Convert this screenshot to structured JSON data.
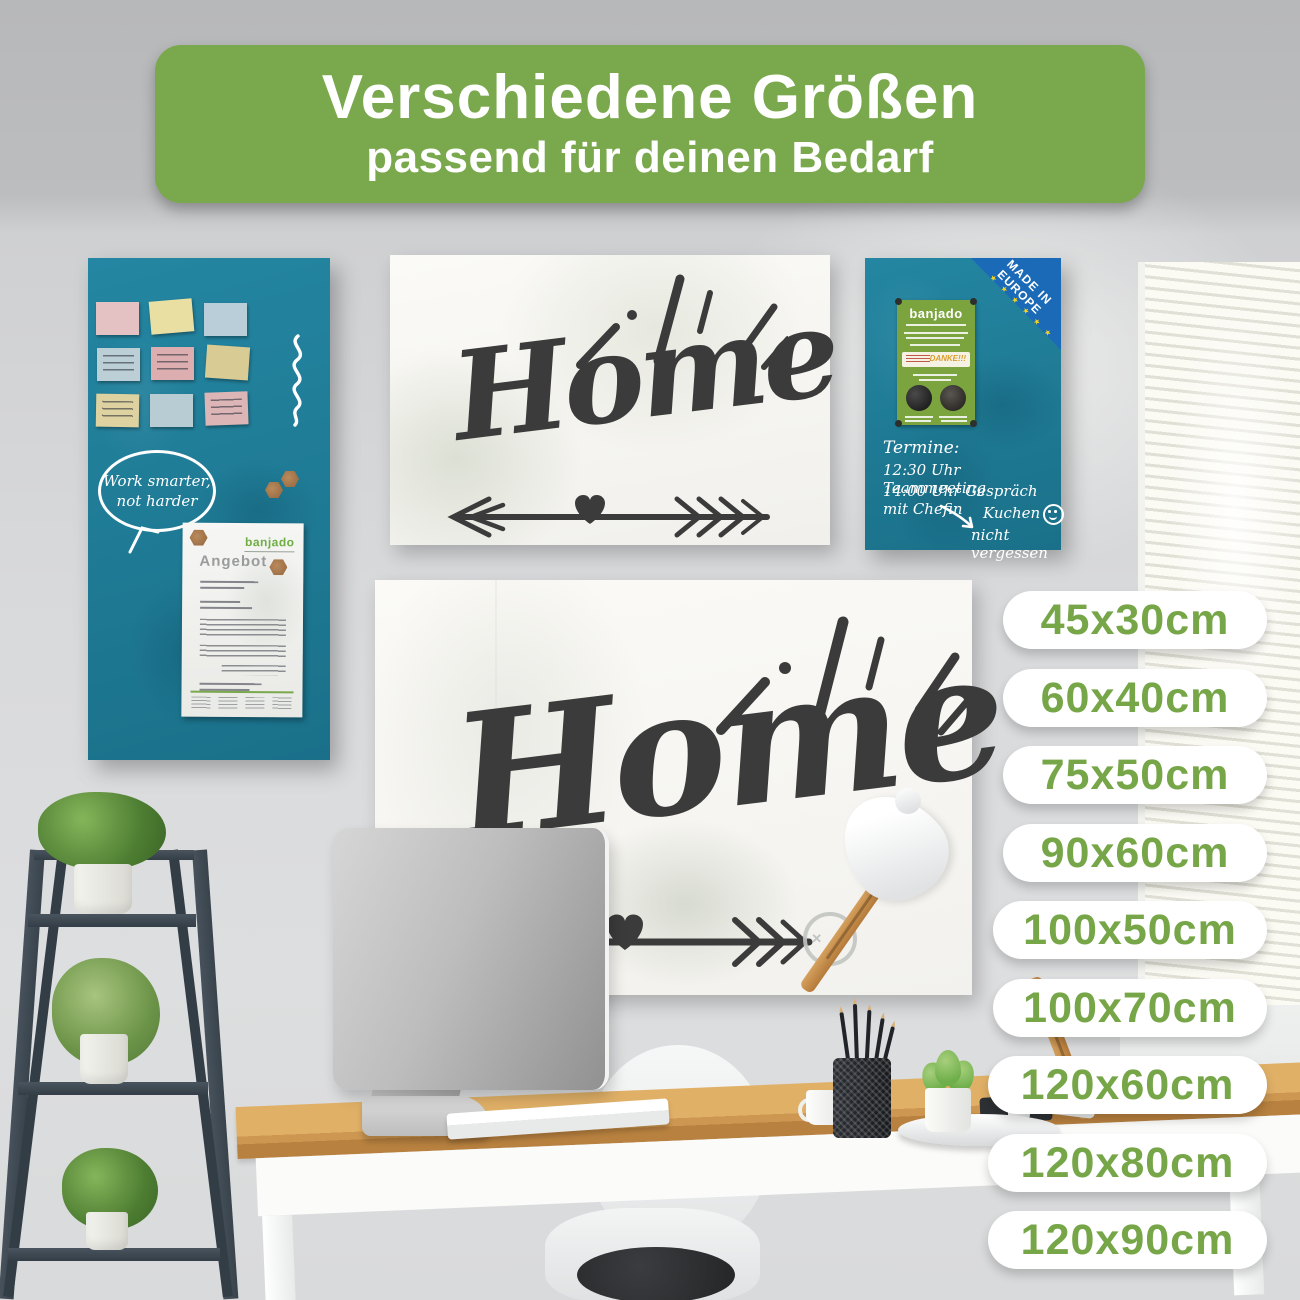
{
  "banner": {
    "title": "Verschiedene Größen",
    "subtitle": "passend für deinen Bedarf"
  },
  "sizes": [
    "45x30cm",
    "60x40cm",
    "75x50cm",
    "90x60cm",
    "100x50cm",
    "100x70cm",
    "120x60cm",
    "120x80cm",
    "120x90cm"
  ],
  "colors": {
    "banner_green": "#7aa84c",
    "pill_text_green": "#76a648",
    "teal_board": "#1f7e99",
    "eu_badge_blue": "#1a6ab7",
    "label_green": "#7ba43f",
    "home_ink": "#3b3b3b"
  },
  "left_board": {
    "speech_bubble": [
      "Work smarter,",
      "not harder"
    ],
    "document": {
      "title": "Angebot",
      "brand": "banjado"
    }
  },
  "right_board": {
    "badge": [
      "MADE IN",
      "EUROPE"
    ],
    "badge_stars": "★ ★ ★ ★ ★ ★",
    "label": {
      "brand": "banjado",
      "thanks": "DANKE!!!"
    },
    "notes": [
      "Termine:",
      "12:30 Uhr Teammeeting",
      "14:00 Uhr Gespräch mit Chefin"
    ],
    "reminder": [
      "Kuchen",
      "nicht vergessen"
    ]
  },
  "home_board_small": {
    "word": "Home"
  },
  "home_board_large": {
    "word": "Home"
  },
  "drawn_smiley_eyes": "✕ ✕"
}
